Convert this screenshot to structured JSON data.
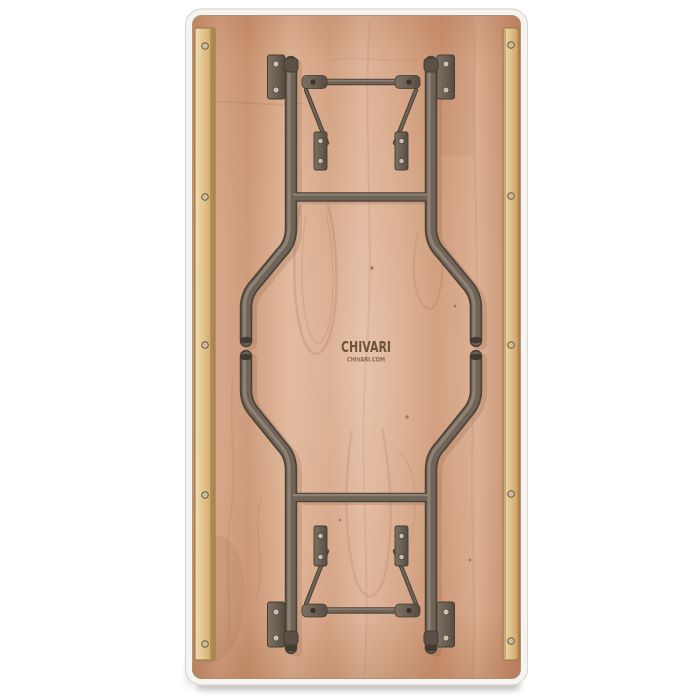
{
  "scene": {
    "type": "product photograph",
    "subject": "Underside of rectangular wood folding table with folded wishbone steel legs",
    "background_color": "#ffffff"
  },
  "brand_stamp": {
    "title": "CHIVARI",
    "subtitle": "CHIVARI.COM"
  },
  "structure": {
    "mounting_rails": 2,
    "screws_per_rail": 5,
    "leg_assemblies": 2,
    "hinge_plates": 4,
    "lock_brackets": 4,
    "spreader_bars": 2,
    "crossbars": 2
  },
  "palette": {
    "background": "#ffffff",
    "edge_band": "#f6f4f0",
    "plywood_mid": "#d09f80",
    "plywood_light": "#e2bb9e",
    "plywood_dark": "#bc8260",
    "rail_wood": "#e6c996",
    "metal_dark": "#4c4339",
    "metal_mid": "#6f6457",
    "metal_highlight": "#958779",
    "metal_shadow": "#8a5a3c",
    "screw_metal": "#cbc0ad",
    "stamp_brown": "#5e452c",
    "shadow_gray": "#aaa7a3"
  }
}
